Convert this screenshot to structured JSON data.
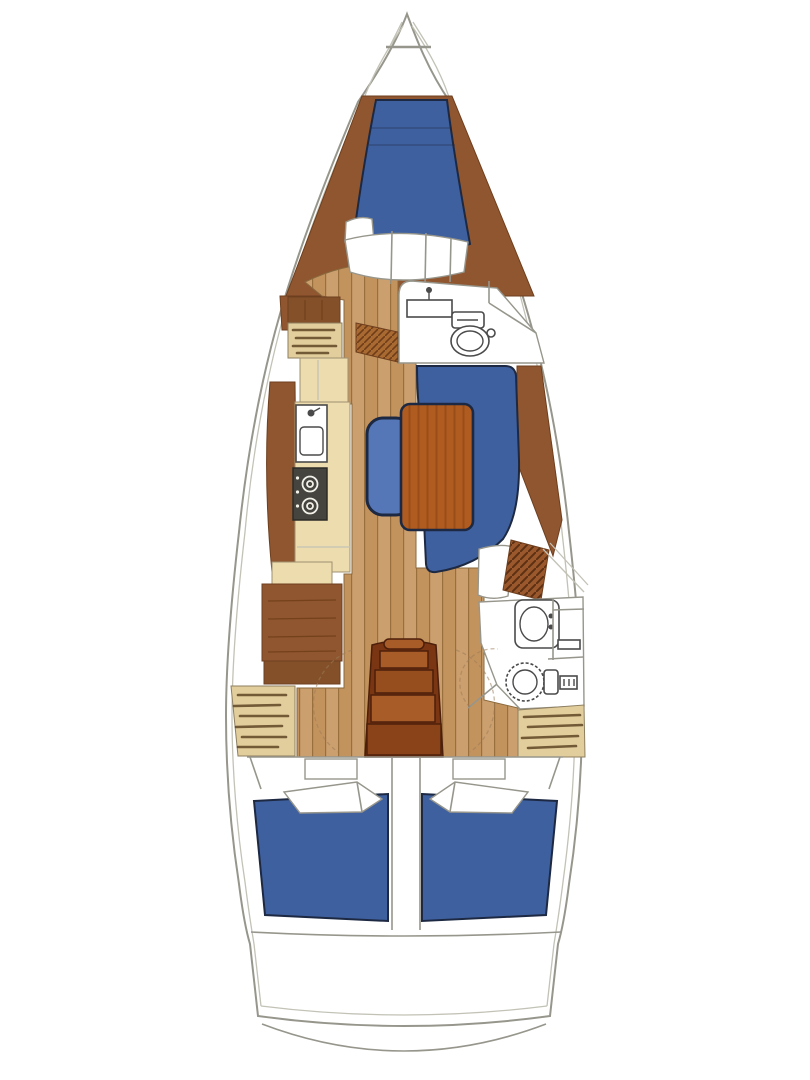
{
  "diagram": {
    "kind": "sailing-yacht-interior-floor-plan",
    "orientation": "bow-at-top-stern-at-bottom",
    "regions": [
      {
        "name": "anchor-locker"
      },
      {
        "name": "forward-cabin-v-berth"
      },
      {
        "name": "forward-head"
      },
      {
        "name": "port-wardrobe-and-lockers"
      },
      {
        "name": "galley"
      },
      {
        "name": "salon-settee-and-table"
      },
      {
        "name": "navigation-station"
      },
      {
        "name": "aft-head"
      },
      {
        "name": "companionway-steps"
      },
      {
        "name": "aft-cabin-port"
      },
      {
        "name": "aft-cabin-starboard"
      },
      {
        "name": "transom-swim-platform"
      }
    ]
  },
  "colors": {
    "page-bg": "#ffffff",
    "hull-line": "#97968c",
    "hull-inner-line": "#c3c2b6",
    "wood-trim": "#8f5630",
    "wood-dark": "#84502a",
    "wood-edge": "#6e3f1e",
    "wood-grain": "#6d3c17",
    "floor-plank": "#c3935e",
    "floor-plank-light": "#cc9f6e",
    "floor-plank-line": "#9a6f3e",
    "cushion-blue": "#3e609f",
    "bench-blue": "#5577b8",
    "cushion-outline": "#1d2942",
    "counter-beige": "#ecdcae",
    "locker-beige": "#e2cd9c",
    "hatch-stroke": "#5f4526",
    "table-wood": "#b05c20",
    "table-wood-dark": "#9a4d18",
    "step-dark": "#7a3513",
    "step-light": "#a85c28",
    "step-outline": "#4c1f0a",
    "stove-dark": "#45443f",
    "fixture-line": "#4a4a4a"
  }
}
